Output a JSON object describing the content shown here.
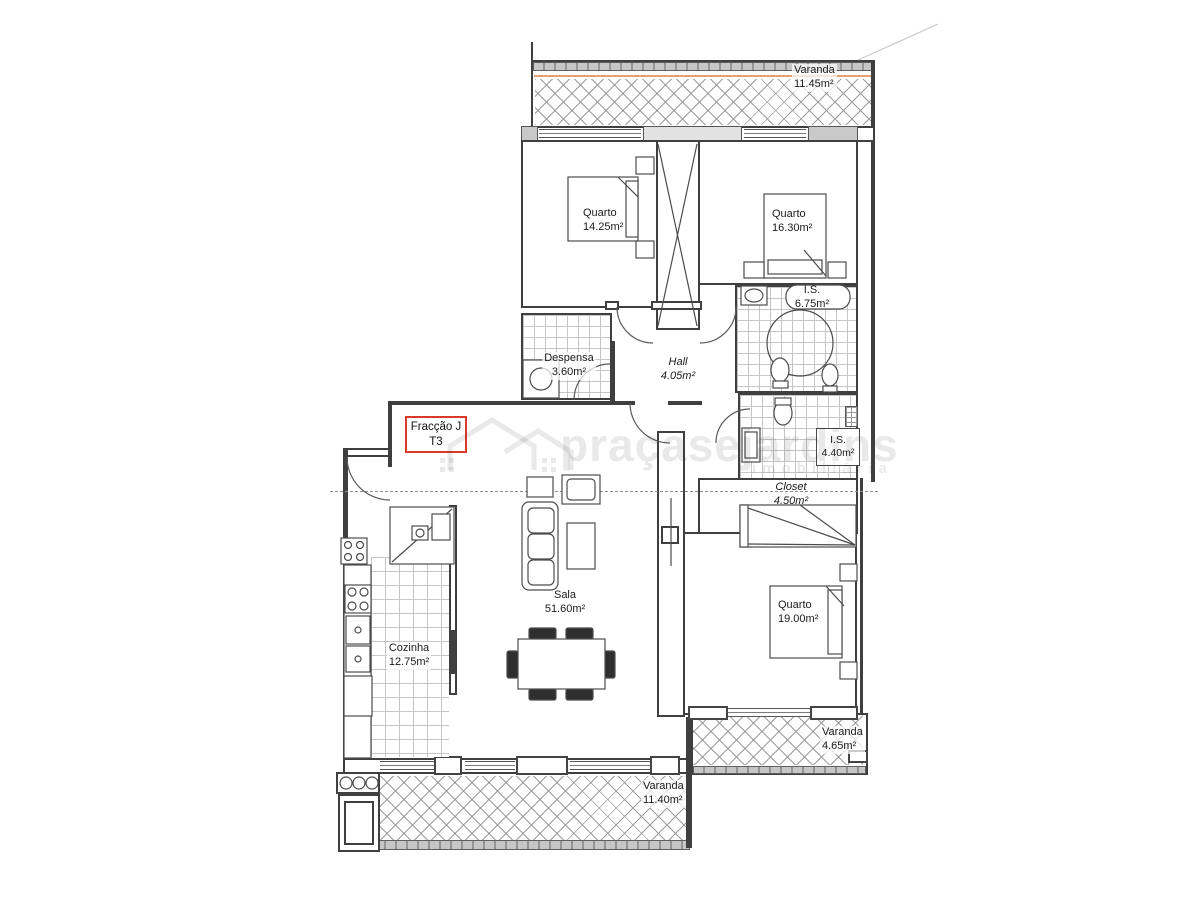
{
  "plan": {
    "unit": {
      "fraction": "Fracção J",
      "typology": "T3"
    },
    "watermark": {
      "brand": "praçasejardins",
      "tagline": "imobiliária"
    },
    "rooms": {
      "varanda_top": {
        "name": "Varanda",
        "area": "11.45m²"
      },
      "quarto_1": {
        "name": "Quarto",
        "area": "14.25m²"
      },
      "quarto_2": {
        "name": "Quarto",
        "area": "16.30m²"
      },
      "is_1": {
        "name": "I.S.",
        "area": "6.75m²"
      },
      "despensa": {
        "name": "Despensa",
        "area": "3.60m²"
      },
      "hall": {
        "name": "Hall",
        "area": "4.05m²"
      },
      "is_2": {
        "name": "I.S.",
        "area": "4.40m²"
      },
      "closet": {
        "name": "Closet",
        "area": "4.50m²"
      },
      "quarto_3": {
        "name": "Quarto",
        "area": "19.00m²"
      },
      "sala": {
        "name": "Sala",
        "area": "51.60m²"
      },
      "cozinha": {
        "name": "Cozinha",
        "area": "12.75m²"
      },
      "varanda_right": {
        "name": "Varanda",
        "area": "4.65m²"
      },
      "varanda_bottom": {
        "name": "Varanda",
        "area": "11.40m²"
      }
    },
    "colors": {
      "accent_red": "#d93a2b",
      "balcony_line_orange": "#e8a071",
      "wall": "#3f3f3f"
    }
  }
}
